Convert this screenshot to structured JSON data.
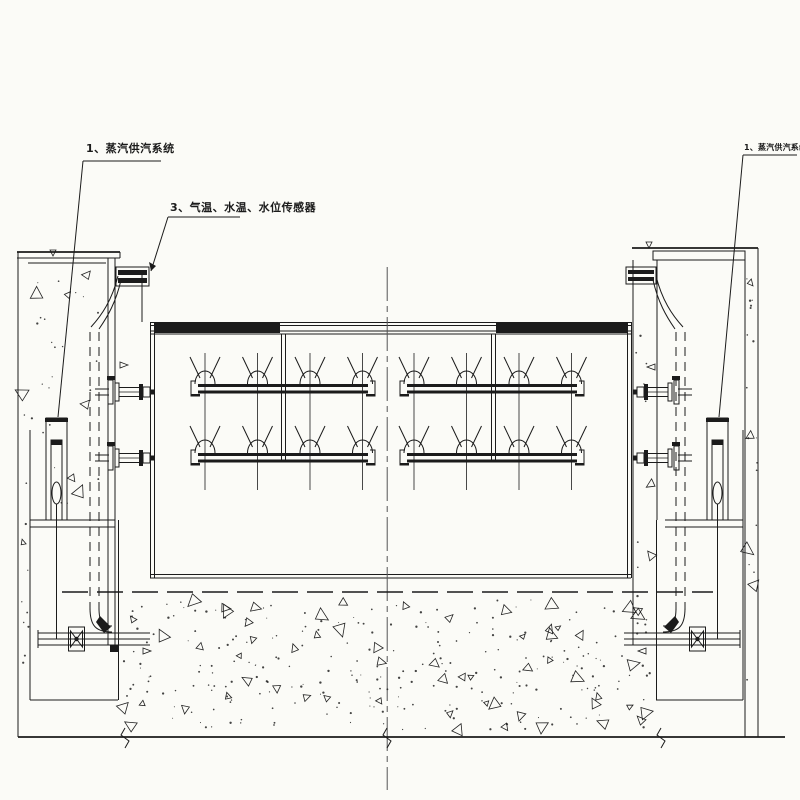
{
  "drawing": {
    "type": "engineering-section-drawing",
    "labels": {
      "steam_supply_left": "1、蒸汽供汽系统",
      "sensors": "3、气温、水温、水位传感器",
      "steam_supply_right": "1、蒸汽供汽系统"
    },
    "colors": {
      "background": "#fbfbf7",
      "line": "#1b1b1b",
      "centerline": "#555555"
    }
  }
}
